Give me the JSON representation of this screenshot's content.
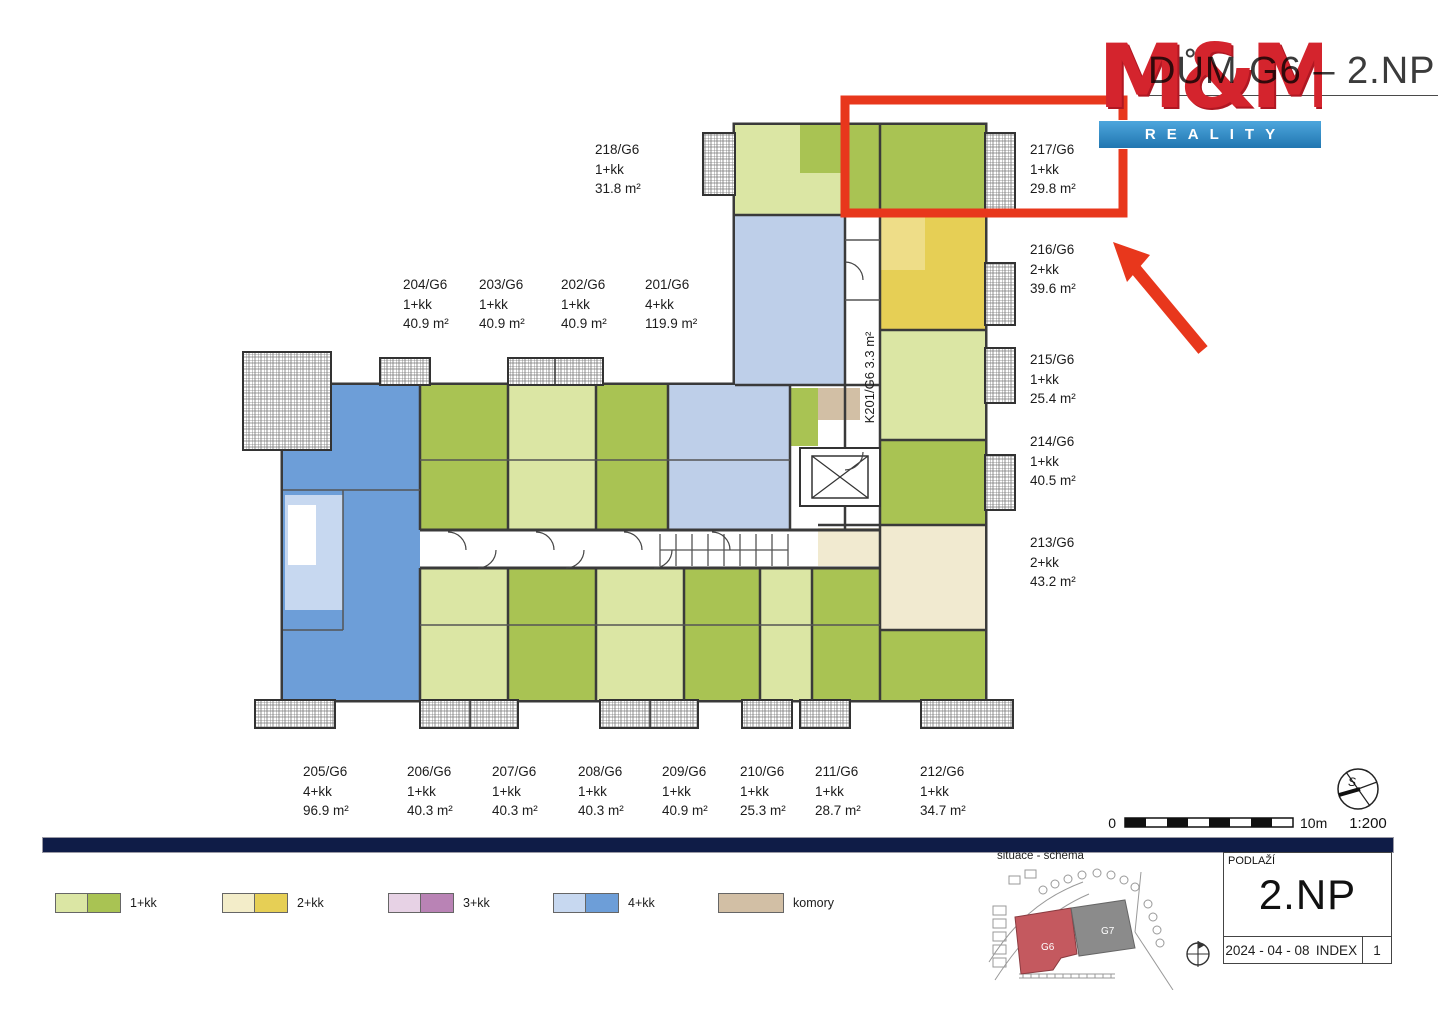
{
  "header": {
    "title": "DŮM G6 – 2.NP",
    "logo_top": "M&M",
    "logo_bottom": "REALITY"
  },
  "plan": {
    "corridor_cell_label": "K201/G6  3.3 m²"
  },
  "apartments": [
    {
      "id": "218/G6",
      "type": "1+kk",
      "area": "31.8 m²"
    },
    {
      "id": "217/G6",
      "type": "1+kk",
      "area": "29.8 m²"
    },
    {
      "id": "216/G6",
      "type": "2+kk",
      "area": "39.6 m²"
    },
    {
      "id": "215/G6",
      "type": "1+kk",
      "area": "25.4 m²"
    },
    {
      "id": "214/G6",
      "type": "1+kk",
      "area": "40.5 m²"
    },
    {
      "id": "213/G6",
      "type": "2+kk",
      "area": "43.2 m²"
    },
    {
      "id": "204/G6",
      "type": "1+kk",
      "area": "40.9 m²"
    },
    {
      "id": "203/G6",
      "type": "1+kk",
      "area": "40.9 m²"
    },
    {
      "id": "202/G6",
      "type": "1+kk",
      "area": "40.9 m²"
    },
    {
      "id": "201/G6",
      "type": "4+kk",
      "area": "119.9 m²"
    },
    {
      "id": "205/G6",
      "type": "4+kk",
      "area": "96.9 m²"
    },
    {
      "id": "206/G6",
      "type": "1+kk",
      "area": "40.3 m²"
    },
    {
      "id": "207/G6",
      "type": "1+kk",
      "area": "40.3 m²"
    },
    {
      "id": "208/G6",
      "type": "1+kk",
      "area": "40.3 m²"
    },
    {
      "id": "209/G6",
      "type": "1+kk",
      "area": "40.9 m²"
    },
    {
      "id": "210/G6",
      "type": "1+kk",
      "area": "25.3 m²"
    },
    {
      "id": "211/G6",
      "type": "1+kk",
      "area": "28.7 m²"
    },
    {
      "id": "212/G6",
      "type": "1+kk",
      "area": "34.7 m²"
    }
  ],
  "legend": {
    "items": [
      {
        "label": "1+kk",
        "colors": [
          "#dbe6a4",
          "#a9c353"
        ]
      },
      {
        "label": "2+kk",
        "colors": [
          "#f3edc9",
          "#e6cf55"
        ]
      },
      {
        "label": "3+kk",
        "colors": [
          "#e7d2e5",
          "#b983b5"
        ]
      },
      {
        "label": "4+kk",
        "colors": [
          "#c7d8f0",
          "#6d9ed8"
        ]
      },
      {
        "label": "komory",
        "colors": [
          "#d2bfa5"
        ]
      }
    ]
  },
  "scalebar": {
    "zero": "0",
    "max": "10m",
    "ratio": "1:200",
    "north": "S"
  },
  "site": {
    "caption": "situace - schéma",
    "building_highlight": "G6",
    "building_other": "G7"
  },
  "titleblock": {
    "label": "PODLAŽÍ",
    "floor": "2.NP",
    "date": "2024 - 04 - 08",
    "index_label": "INDEX",
    "index_value": "1"
  },
  "annotation": {
    "highlight_color": "#e8371c"
  }
}
